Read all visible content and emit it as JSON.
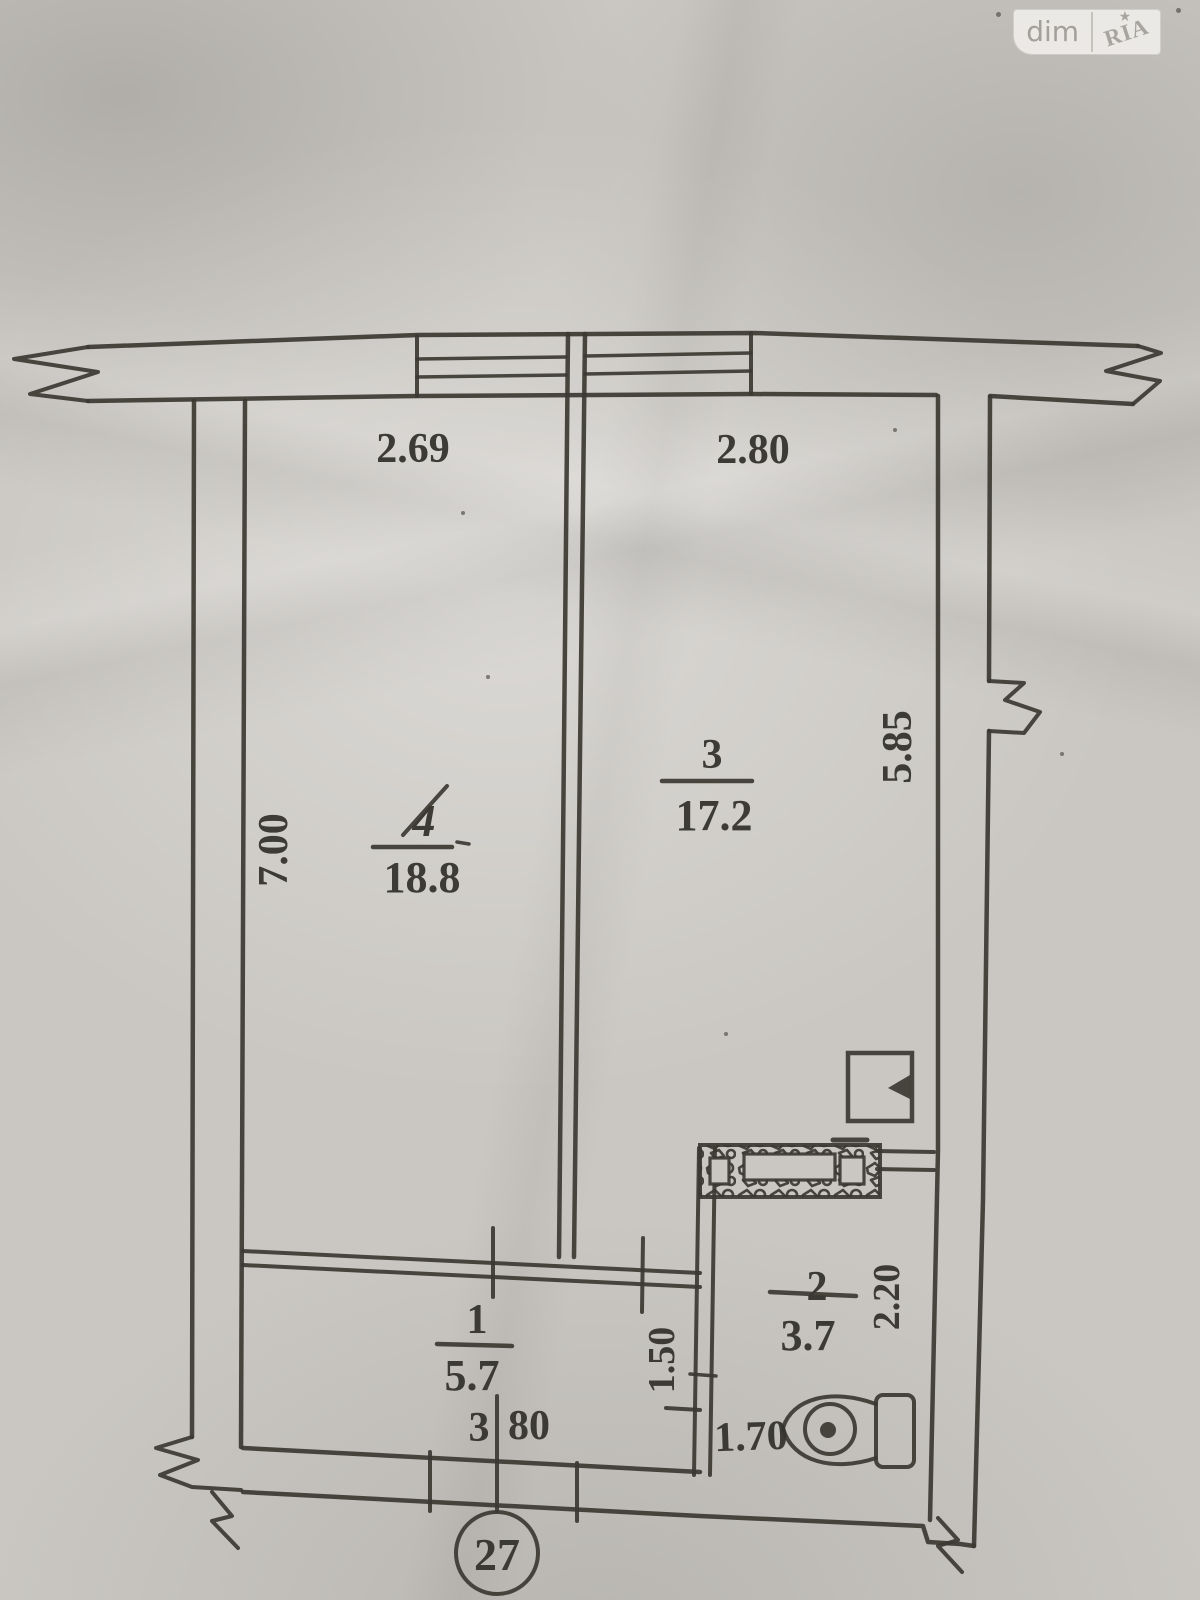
{
  "watermark": {
    "left_label": "dim",
    "right_label": "RIA",
    "star": "★"
  },
  "plan": {
    "flat_number": "27",
    "rooms": [
      {
        "number": "4",
        "area": "18.8"
      },
      {
        "number": "3",
        "area": "17.2"
      },
      {
        "number": "1",
        "area": "5.7"
      },
      {
        "number": "2",
        "area": "3.7"
      }
    ],
    "dimensions": {
      "top_left": "2.69",
      "top_right": "2.80",
      "left_side": "7.00",
      "right_side": "5.85",
      "bottom_whole": "3",
      "bottom_frac": "80",
      "hall_depth": "1.50",
      "bath_width": "1.70",
      "bath_depth": "2.20"
    }
  },
  "colors": {
    "paper": "#cac7c2",
    "ink": "#3b3831",
    "watermark_bg": "#edebe7",
    "watermark_text": "#a3a09b"
  }
}
